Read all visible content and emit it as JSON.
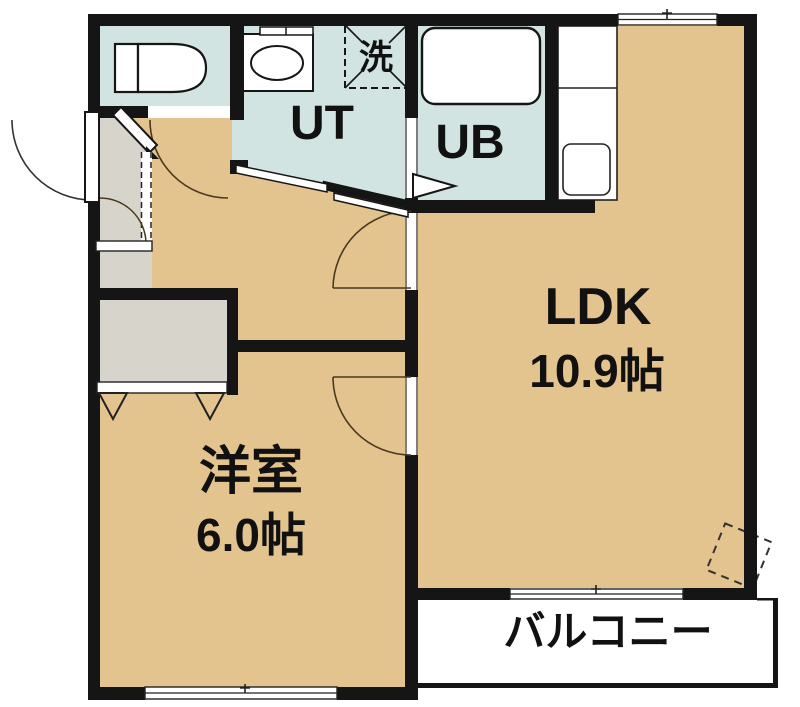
{
  "plan": {
    "title": "1LDK apartment floor plan",
    "rooms": {
      "ldk": {
        "label": "LDK",
        "size": "10.9帖"
      },
      "western_room": {
        "label": "洋室",
        "size": "6.0帖"
      },
      "utility": {
        "label": "UT"
      },
      "unit_bath": {
        "label": "UB"
      },
      "laundry_space": {
        "label": "洗"
      },
      "balcony": {
        "label": "バルコニー"
      }
    },
    "colors": {
      "floor_tan": "#e3c48e",
      "wet_area_teal": "#d2e4e1",
      "entrance_gray": "#d7d5cb",
      "wall_black": "#151515",
      "background": "#ffffff"
    }
  }
}
